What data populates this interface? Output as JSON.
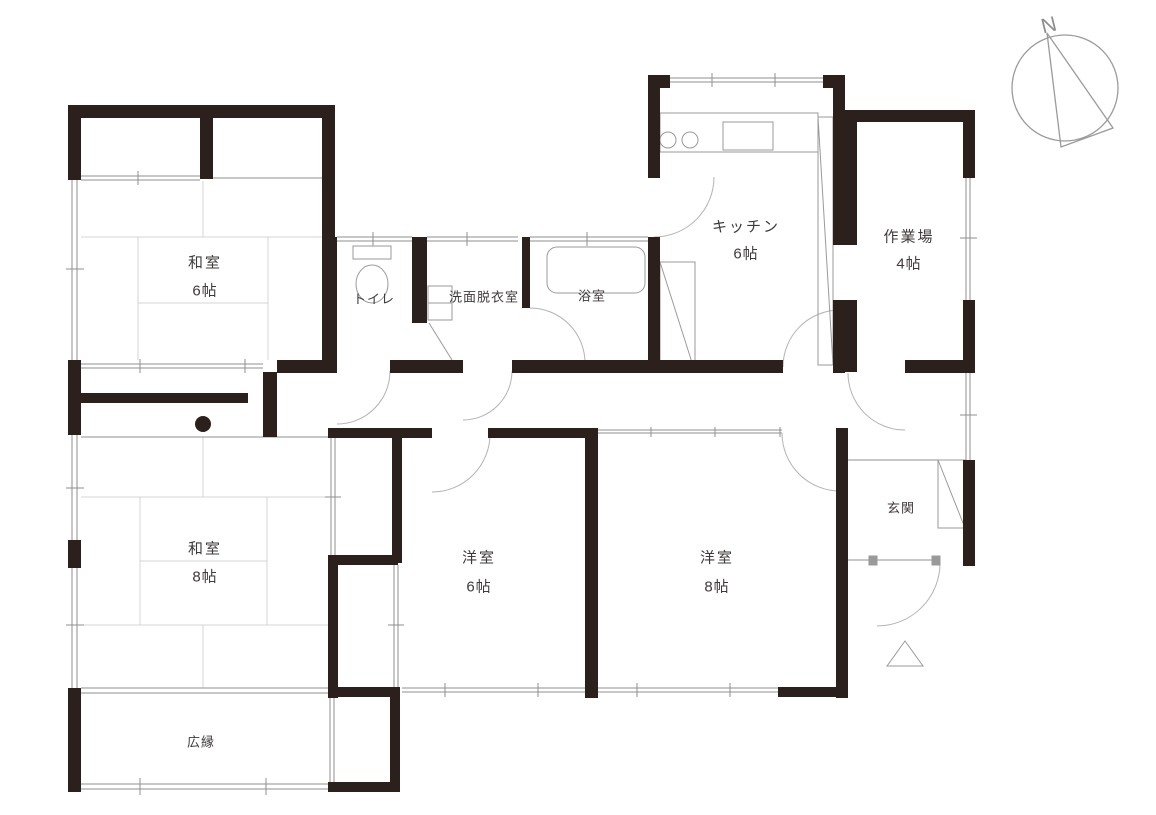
{
  "figure": {
    "type": "japanese-floor-plan",
    "compass_label": "N"
  },
  "rooms": [
    {
      "name": "和室",
      "size": "6帖"
    },
    {
      "name": "和室",
      "size": "8帖"
    },
    {
      "name": "トイレ"
    },
    {
      "name": "洗面脱衣室"
    },
    {
      "name": "浴室"
    },
    {
      "name": "キッチン",
      "size": "6帖"
    },
    {
      "name": "作業場",
      "size": "4帖"
    },
    {
      "name": "洋室",
      "size": "6帖"
    },
    {
      "name": "洋室",
      "size": "8帖"
    },
    {
      "name": "玄関"
    },
    {
      "name": "広縁"
    }
  ],
  "icons": {
    "compass": "north-arrow",
    "entrance_marker": "triangle",
    "pillar": "dot",
    "fixtures": [
      "toilet",
      "washbasin",
      "bathtub",
      "kitchen-counter",
      "shoe-cabinet"
    ]
  },
  "colors": {
    "wall": "#2b201b",
    "thin_line": "#8f8f8f",
    "tatami_line": "#d4d4d4",
    "door_arc": "#b3b3b3",
    "background": "#ffffff",
    "text": "#3f3a39"
  }
}
